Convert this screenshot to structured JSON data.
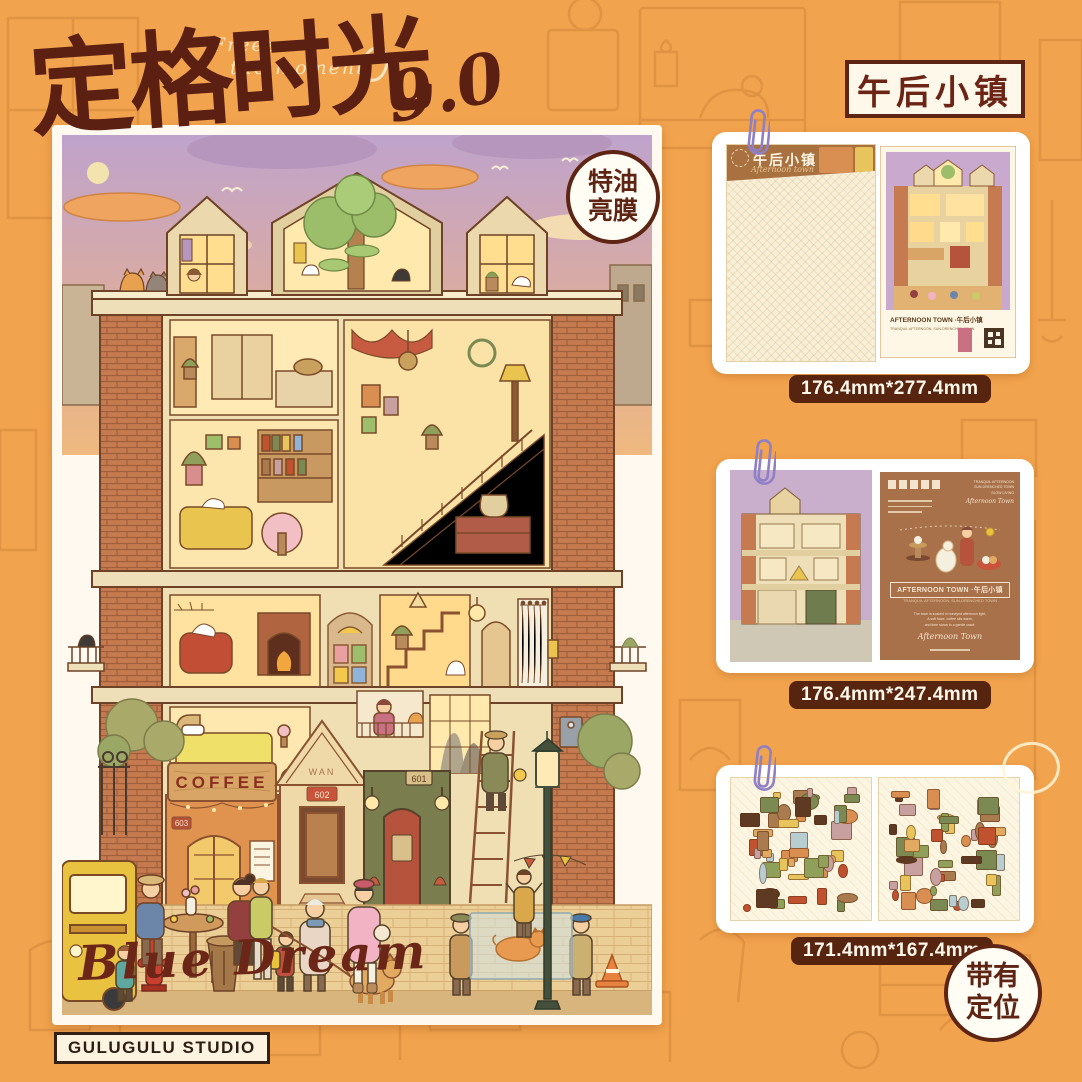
{
  "header": {
    "subtitle_line1": "Freeze",
    "subtitle_line2": "the moment",
    "title_zh": "定格时光",
    "version": "9.0",
    "film_badge": {
      "line1": "特油",
      "line2": "亮膜"
    },
    "series_badge": "午后小镇"
  },
  "poster": {
    "coffee_sign": "COFFEE",
    "gable_text": "WAN",
    "plate_left": "603",
    "plate_center": "602",
    "plate_right": "601",
    "watermark": "Blue Dream"
  },
  "products": [
    {
      "name": "sticky-backing-and-poster",
      "size_label": "176.4mm*277.4mm",
      "sheet": {
        "title": "午后小镇",
        "script": "Afternoon town"
      },
      "mini_title": "AFTERNOON TOWN ·午后小镇",
      "mini_subtitle": "TRANQUIL AFTERNOON, SUN-DRENCHED TOWN"
    },
    {
      "name": "base-card-front-back",
      "size_label": "176.4mm*247.4mm",
      "back": {
        "corner_line1": "TRANQUIL AFTERNOON",
        "corner_line2": "SUN-DRENCHED TOWN",
        "corner_line3": "SLOW LIVING",
        "title": "AFTERNOON TOWN ·午后小镇",
        "subtitle": "TRANQUIL AFTERNOON, SUN-DRENCHED TOWN",
        "body_line1": "The town is soaked in honeyed afternoon light,",
        "body_line2": "A soft haze, coffee sits warm,",
        "body_line3": "and time slows to a gentle crawl.",
        "script": "Afternoon Town"
      }
    },
    {
      "name": "sticker-sheets",
      "size_label": "171.4mm*167.4mm"
    }
  ],
  "positioning_badge": {
    "line1": "带有",
    "line2": "定位"
  },
  "footer": {
    "studio": "GULUGULU STUDIO"
  },
  "colors": {
    "background": "#F2A34D",
    "accent_dark": "#5E2414",
    "label_bg": "#57240F",
    "paperclip": "#8F80C6",
    "sticker_palette": [
      "#C0522F",
      "#D98E52",
      "#8FA05A",
      "#E7C45C",
      "#A97B4F",
      "#7B8A52",
      "#C9A0A0",
      "#5E3A22",
      "#E2AA60",
      "#B8CDD1"
    ]
  }
}
